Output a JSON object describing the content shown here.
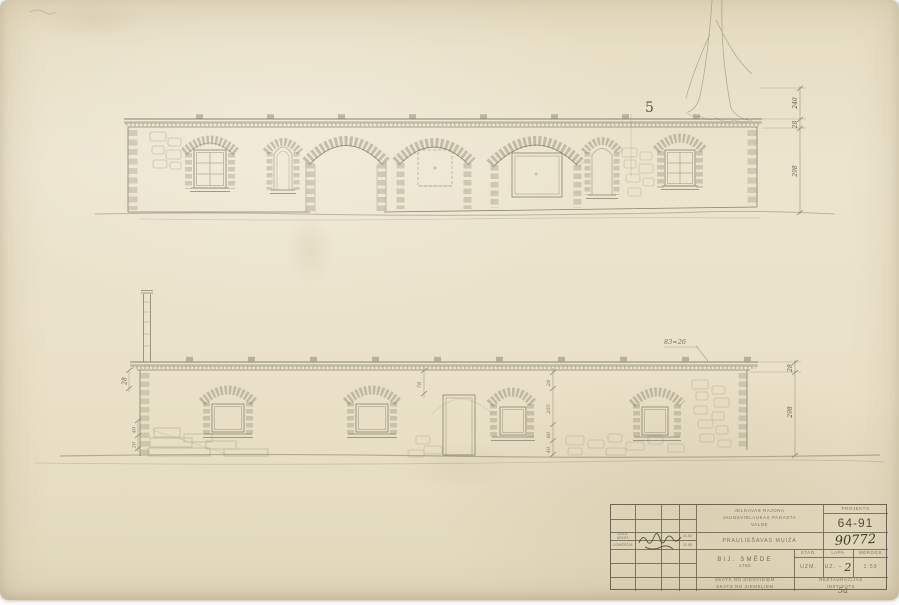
{
  "sheet": {
    "handwritten_mark": "5",
    "corner_mark": "5a"
  },
  "top_elevation": {
    "dims": {
      "roof": "240",
      "cornice": "28",
      "wall": "298"
    }
  },
  "bottom_elevation": {
    "annotation": "83=26",
    "dim_cornice_left": "28",
    "dims_left_small": [
      "40",
      "20"
    ],
    "dim_mid": "78",
    "dim_chain": [
      "28",
      "205",
      "60",
      "40"
    ],
    "dims_right": [
      "28",
      "298"
    ]
  },
  "title_block": {
    "authority_line1": "JELGAVAS RAJONA",
    "authority_line2": "JAUNSVIRLAUKAS PAGASTA",
    "authority_line3": "VALDE",
    "object_name": "PRAULIEŠAVAS MUIŽA",
    "building_name": "BIJ. SMĒDE",
    "building_year": "1790",
    "view_line1": "SKATS NO DIENVIDIEM",
    "view_line2": "SKATS NO ZIEMEĻIEM",
    "project_label": "PROJEKTS",
    "project_number": "64-91",
    "archive_number": "90772",
    "stage_label": "STAD.",
    "sheet_label": "LAPA",
    "scale_label": "MĒROGS",
    "stage_value": "UZM.",
    "sheet_prefix": "UZ. –",
    "sheet_number": "2",
    "scale_value": "1:50",
    "org_line1": "RESTAURĀCIJAS",
    "org_line2": "INSTITŪTS",
    "sign_rows": [
      {
        "role": "GALV. ARHIT.",
        "date": "11.92"
      },
      {
        "role": "UZMĒRĪJA",
        "date": "11.92"
      }
    ]
  }
}
